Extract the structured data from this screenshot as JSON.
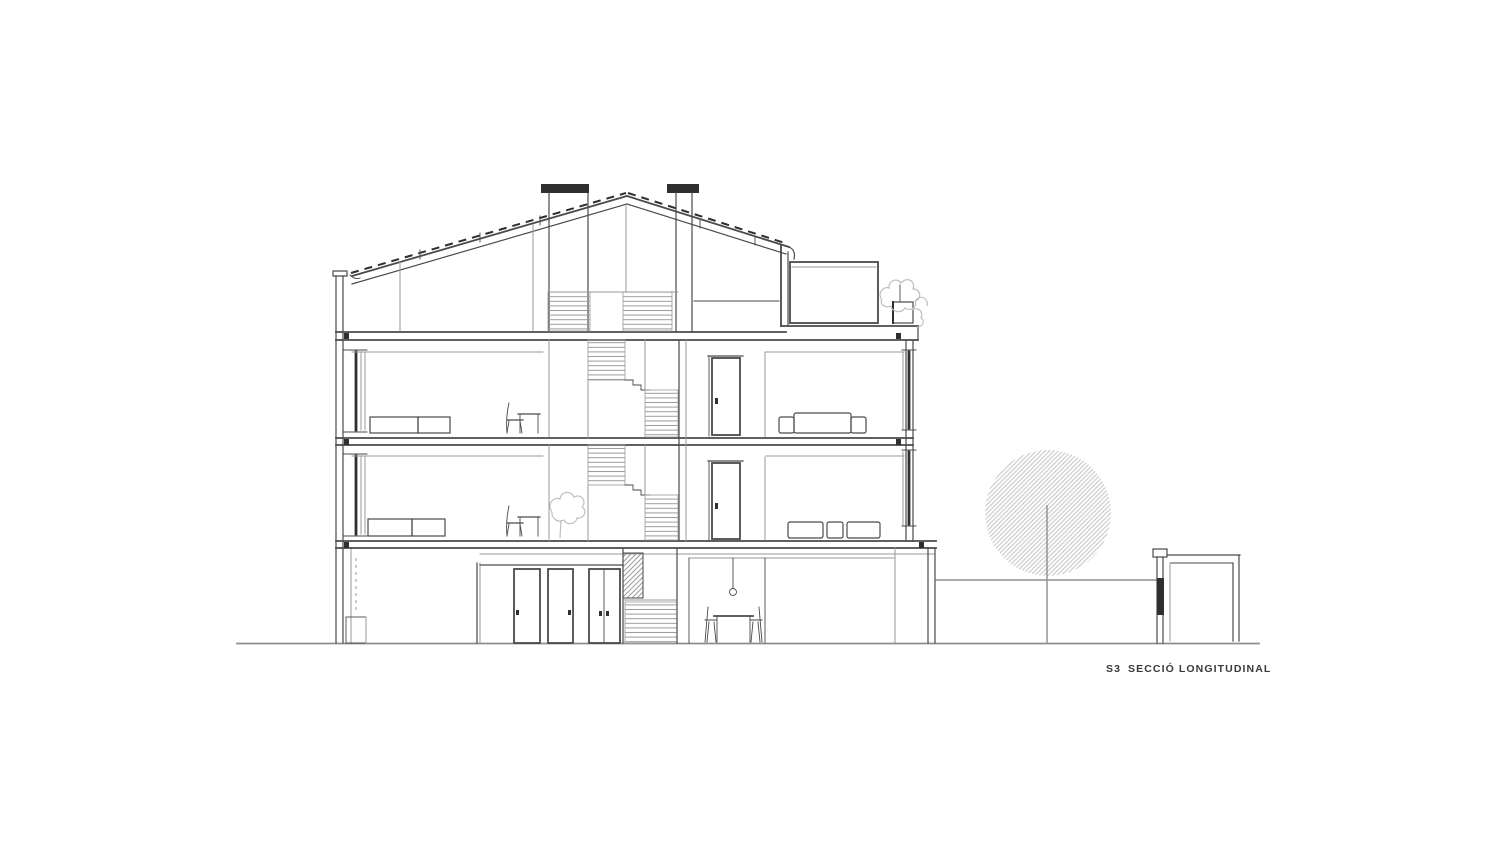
{
  "page": {
    "background_color": "#ffffff"
  },
  "drawing": {
    "label": {
      "code": "S3",
      "title": "SECCIÓ LONGITUDINAL"
    },
    "colors": {
      "ink": "#4a4a4a",
      "ink_dark": "#2f2f2f",
      "ink_light": "#9a9a9a",
      "hatch": "#c7c7c7",
      "plant": "#bfbfbf",
      "ground": "#8e8e8e",
      "label_color": "#3a3a3a",
      "background": "#ffffff"
    },
    "elements": [
      "longitudinal-building-section",
      "gable-roof-with-tile-dashes",
      "two-chimneys",
      "attic-level",
      "two-residential-floors",
      "ground-floor-with-entry-doors",
      "central-staircase",
      "roof-terrace-with-planter",
      "garden-wall",
      "tree",
      "garden-shed",
      "ground-line"
    ]
  }
}
